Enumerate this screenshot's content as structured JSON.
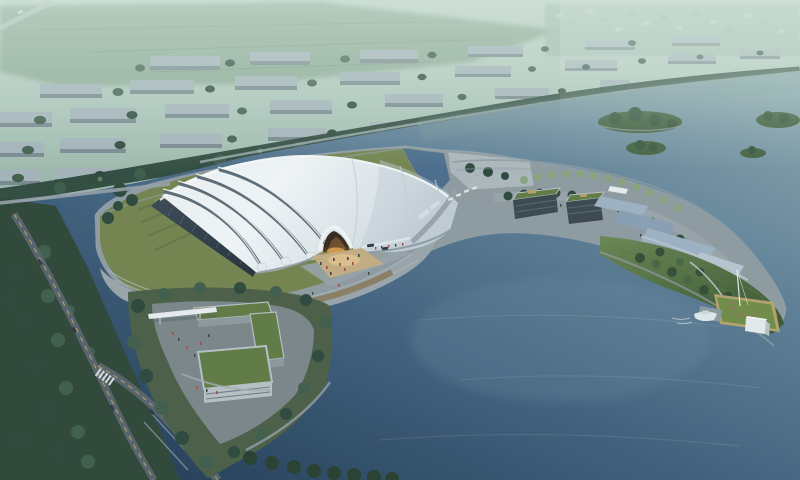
{
  "scene": {
    "description": "Aerial dusk rendering of a lakeside exhibition hall with white ribbed shell roof, glowing arched entrance, waterfront promenades, tree-lined roads, a gatehouse island and a floating lawn platform with a boat",
    "objects": {
      "main_hall": "white curved shell roof with four dark rib grooves and dark glass west facade",
      "entrance": "arched opening with warm orange interior light",
      "buses_parked": 2,
      "cars_visible": 12,
      "boats": 1,
      "tree_islands": 4,
      "green_roof_buildings": 3
    }
  },
  "palette": {
    "haze_top": "#c6d8ce",
    "haze_mid": "#a9c2b6",
    "land_green": "#8ba69b",
    "field_green": "#87a48e",
    "town_speck": "#cfdcd4",
    "block_top": "#a6b4bb",
    "block_side": "#78888f",
    "tree_city": "#3f5c49",
    "tree_dark": "#2c463a",
    "tree_light": "#4f6f52",
    "shore_path": "#a9b5ba",
    "water_light": "#8aa6ae",
    "water_mid": "#5f7f97",
    "water_mid2": "#3c5c7a",
    "water_deep": "#1f3750",
    "water_green": "#7d9b99",
    "island_green": "#44613f",
    "lawn": "#73834c",
    "hedge": "#5d7040",
    "plaza": "#929da5",
    "promenade": "#9aa4ab",
    "step_light": "#b3bcc1",
    "deck_tan": "#8a7b5c",
    "roof_white": "#f1f4f6",
    "roof_shade": "#c0ccd4",
    "roof_rib": "#5b6b77",
    "glass_dark": "#2e3b47",
    "glass_line": "#54636e",
    "entrance_dark": "#342619",
    "glow_orange": "#d89a4a",
    "glow_plaza": "#c6ac82",
    "road": "#57616b",
    "road_line": "#c8ae58",
    "road_light": "#97a1a8",
    "guard_wall": "#b7c1c5",
    "green_roof": "#5f7a41",
    "canopy": "#e9eef1",
    "ramp_blue": "#9db1c3",
    "pier_light": "#b8c3cb",
    "grass_bright": "#6f8d45",
    "path_tan": "#b5a26c",
    "white_struct": "#e6ecef",
    "people_red": "#a8453a",
    "people_dark": "#3a4046",
    "vehicle_dark": "#2e3840",
    "vehicle_white": "#dde4e8",
    "stone_edge": "#8e9aa2"
  }
}
